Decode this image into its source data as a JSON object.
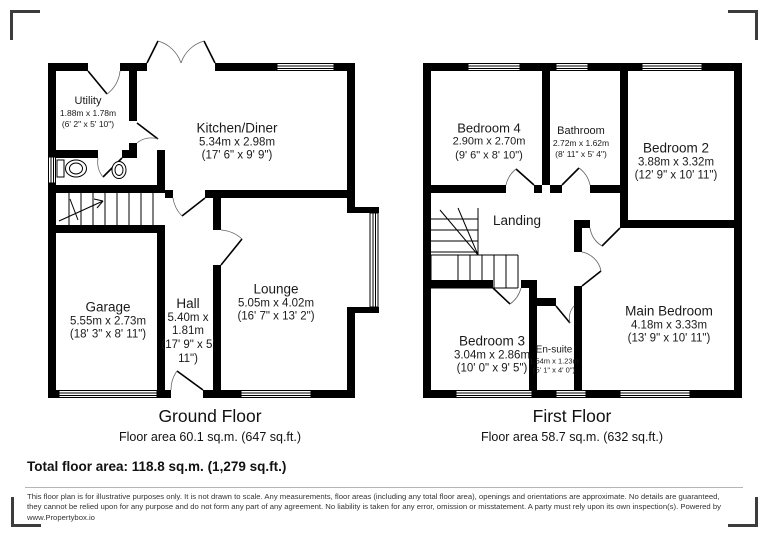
{
  "ground_floor": {
    "title": "Ground Floor",
    "area_label": "Floor area 60.1 sq.m. (647 sq.ft.)",
    "rooms": [
      {
        "name": "Utility",
        "metric": "1.88m x 1.78m",
        "imperial": "(6' 2\" x 5' 10\")"
      },
      {
        "name": "Kitchen/Diner",
        "metric": "5.34m x 2.98m",
        "imperial": "(17' 6\" x 9' 9\")"
      },
      {
        "name": "Garage",
        "metric": "5.55m x 2.73m",
        "imperial": "(18' 3\" x 8' 11\")"
      },
      {
        "name": "Hall",
        "metric": "5.40m x 1.81m",
        "imperial": "(17' 9\" x 5' 11\")"
      },
      {
        "name": "Lounge",
        "metric": "5.05m x 4.02m",
        "imperial": "(16' 7\" x 13' 2\")"
      }
    ]
  },
  "first_floor": {
    "title": "First Floor",
    "area_label": "Floor area 58.7 sq.m. (632 sq.ft.)",
    "rooms": [
      {
        "name": "Bedroom 4",
        "metric": "2.90m x 2.70m",
        "imperial": "(9' 6\" x 8' 10\")"
      },
      {
        "name": "Bathroom",
        "metric": "2.72m x 1.62m",
        "imperial": "(8' 11\" x 5' 4\")"
      },
      {
        "name": "Bedroom 2",
        "metric": "3.88m x 3.32m",
        "imperial": "(12' 9\" x 10' 11\")"
      },
      {
        "name": "Landing"
      },
      {
        "name": "Bedroom 3",
        "metric": "3.04m x 2.86m",
        "imperial": "(10' 0\" x 9' 5\")"
      },
      {
        "name": "En-suite",
        "metric": "1.54m x 1.23m",
        "imperial": "(5' 1\" x 4' 0\")"
      },
      {
        "name": "Main Bedroom",
        "metric": "4.18m x 3.33m",
        "imperial": "(13' 9\" x 10' 11\")"
      }
    ]
  },
  "total_area_label": "Total floor area: 118.8 sq.m. (1,279 sq.ft.)",
  "disclaimer": "This floor plan is for illustrative purposes only. It is not drawn to scale. Any measurements, floor areas (including any total floor area), openings and orientations are approximate. No details are guaranteed, they cannot be relied upon for any purpose and do not form any part of any agreement. No liability is taken for any error, omission or misstatement. A party must rely upon its own inspection(s). Powered by www.Propertybox.io",
  "colors": {
    "wall": "#000000",
    "background": "#ffffff",
    "bracket": "#3c3c3c",
    "text": "#1a1a1a"
  }
}
